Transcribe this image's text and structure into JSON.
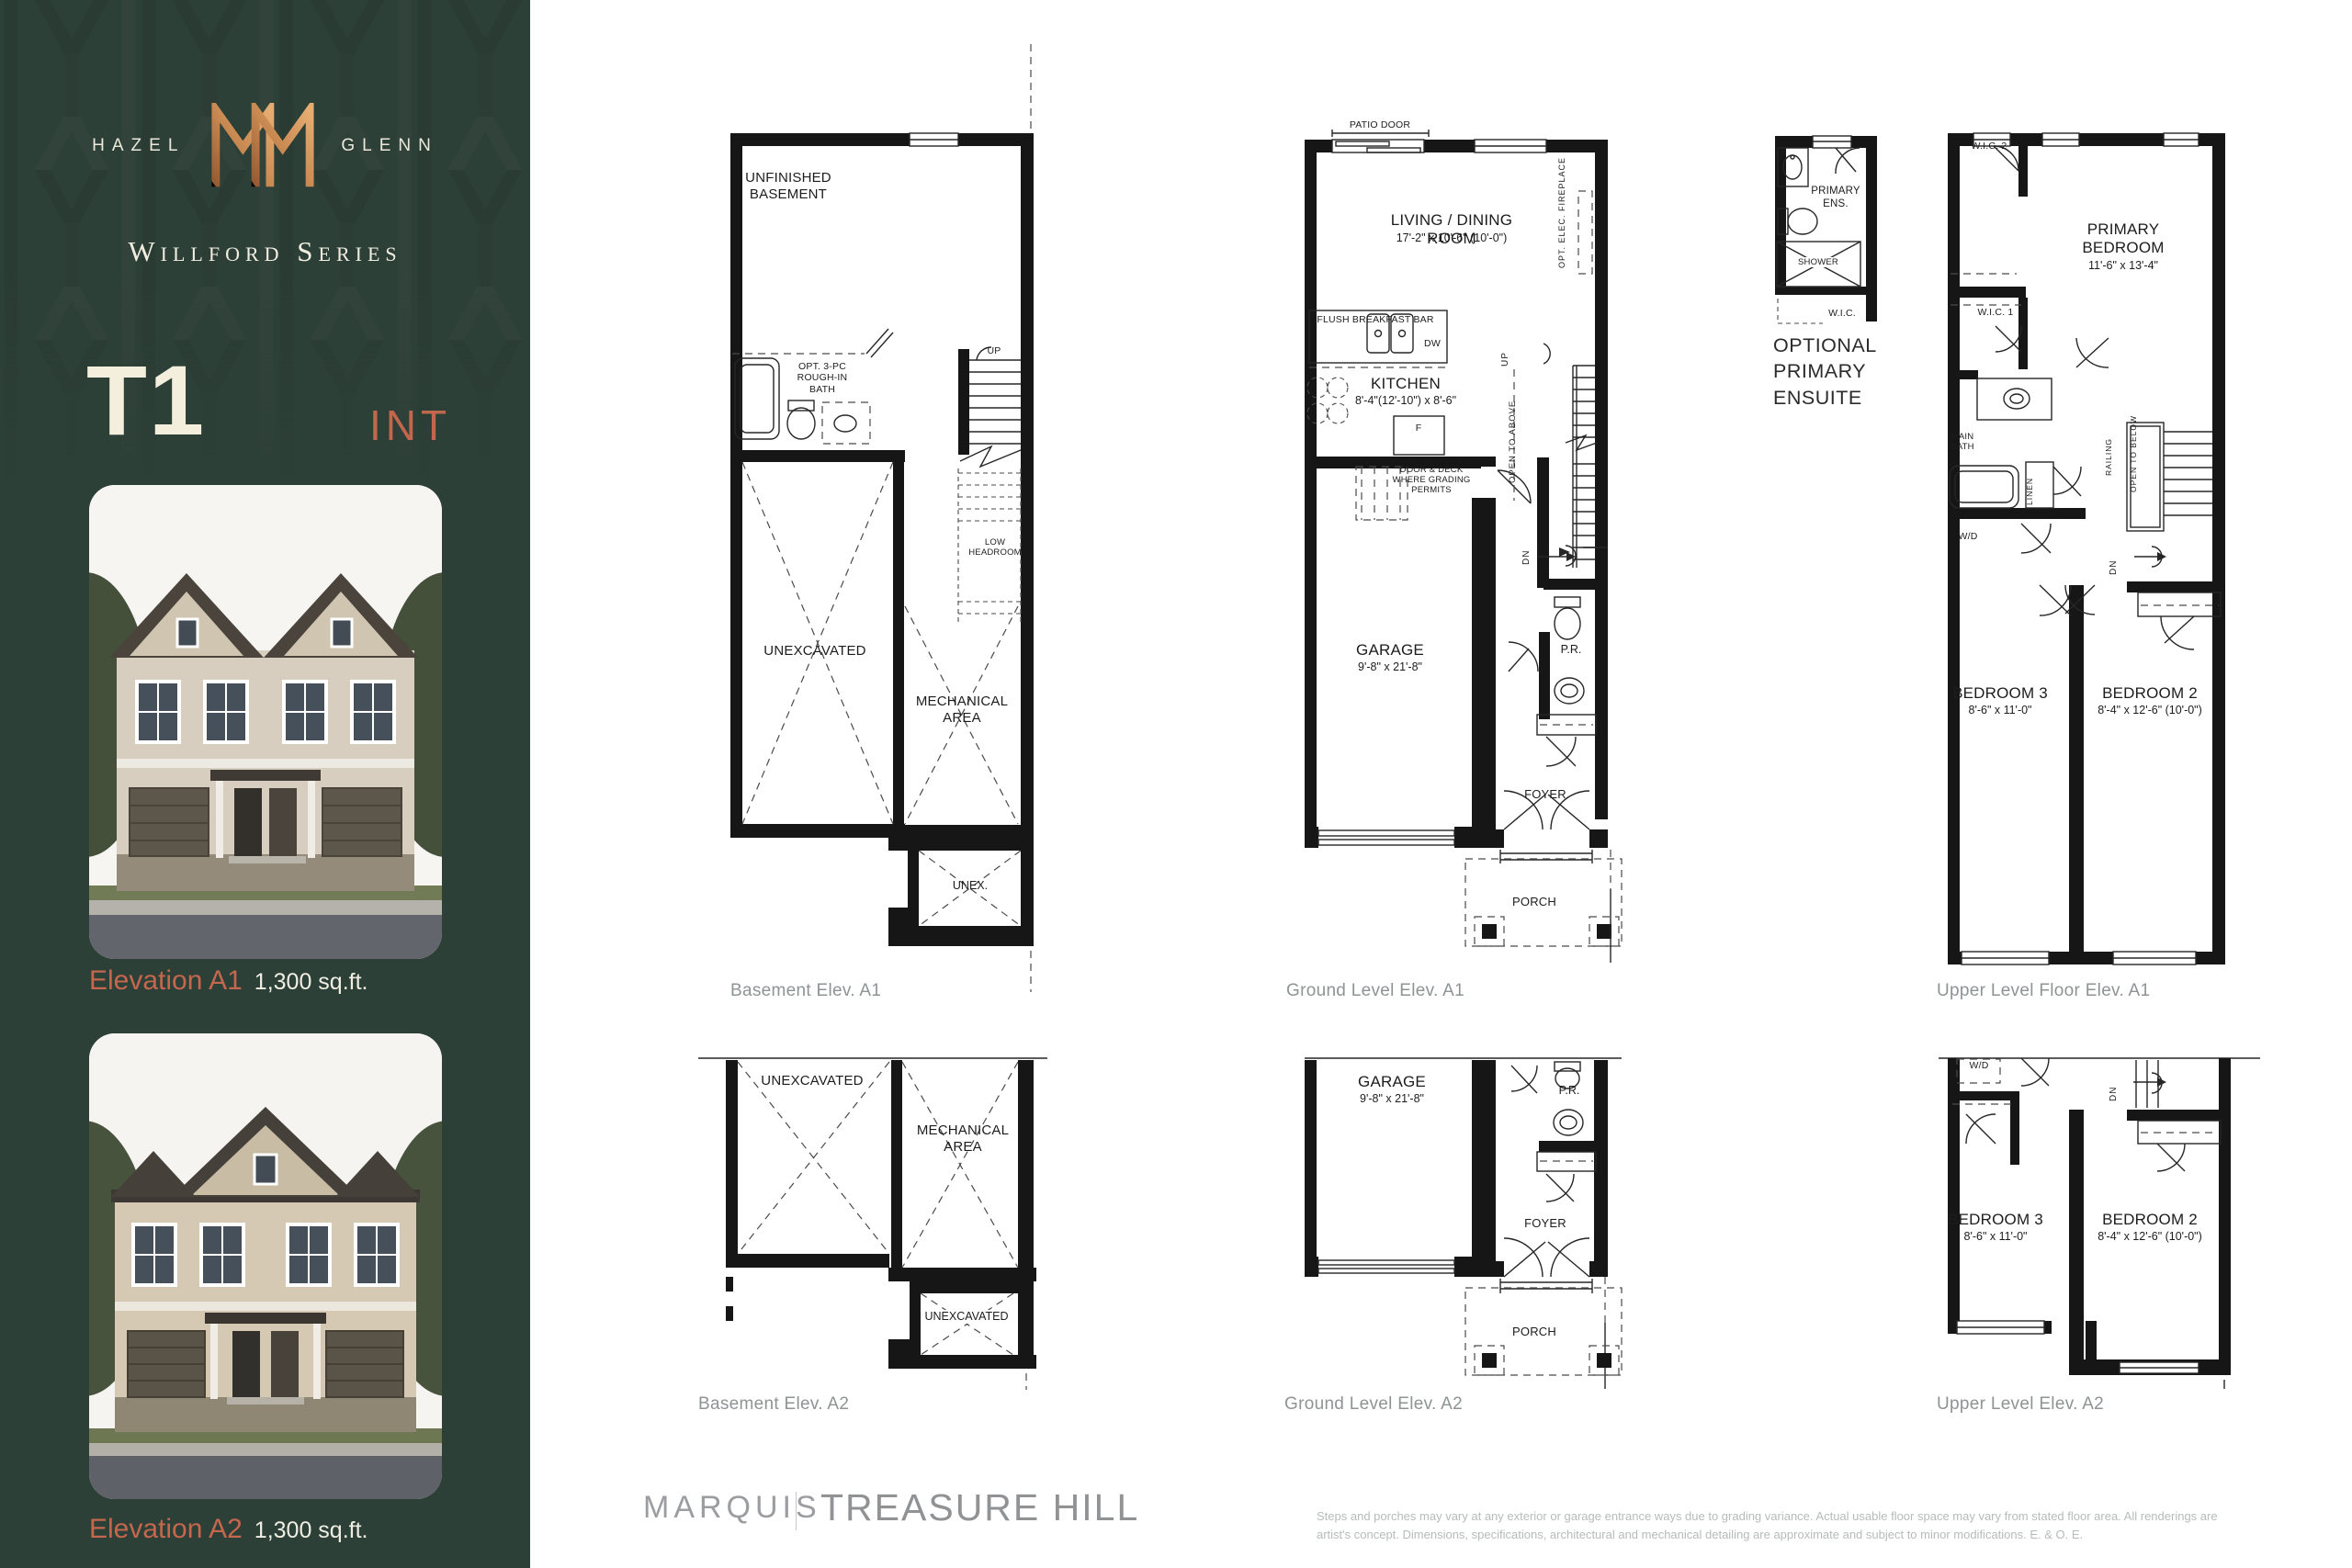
{
  "sidebar": {
    "brand_left": "HAZEL",
    "brand_right": "GLENN",
    "series": "Willford Series",
    "model": "T1",
    "model_tag": "INT",
    "elevations": [
      {
        "label": "Elevation A1",
        "area": "1,300 sq.ft."
      },
      {
        "label": "Elevation A2",
        "area": "1,300 sq.ft."
      }
    ]
  },
  "plans": {
    "basement_a1": {
      "caption": "Basement Elev. A1",
      "unfinished": "UNFINISHED\nBASEMENT",
      "opt_bath": "OPT. 3-PC\nROUGH-IN\nBATH",
      "up": "UP",
      "low_headroom": "LOW\nHEADROOM",
      "unexcavated": "UNEXCAVATED",
      "mechanical": "MECHANICAL\nAREA",
      "unex": "UNEX."
    },
    "ground_a1": {
      "caption": "Ground Level Elev. A1",
      "patio_door": "PATIO DOOR",
      "living": "LIVING / DINING ROOM",
      "living_dims": "17'-2\" x 10'-6\" (10'-0\")",
      "fireplace": "OPT. ELEC. FIREPLACE",
      "breakfast_bar": "FLUSH BREAKFAST BAR",
      "dw": "DW",
      "kitchen": "KITCHEN",
      "kitchen_dims": "8'-4\"(12'-10\") x 8'-6\"",
      "fridge": "F",
      "up": "UP",
      "door_deck": "DOOR & DECK\nWHERE GRADING\nPERMITS",
      "open_above": "OPEN TO ABOVE",
      "dn": "DN",
      "garage": "GARAGE",
      "garage_dims": "9'-8\" x 21'-8\"",
      "pr": "P.R.",
      "foyer": "FOYER",
      "porch": "PORCH"
    },
    "upper_a1": {
      "caption": "Upper Level Floor Elev. A1",
      "wic2": "W.I.C. 2",
      "primary": "PRIMARY\nBEDROOM",
      "primary_dims": "11'-6\" x 13'-4\"",
      "wic1": "W.I.C. 1",
      "main_bath": "MAIN\nBATH",
      "linen": "LINEN",
      "wd": "W/D",
      "railing": "RAILING",
      "open_below": "OPEN TO BELOW",
      "dn": "DN",
      "bedroom3": "BEDROOM 3",
      "bedroom3_dims": "8'-6\" x 11'-0\"",
      "bedroom2": "BEDROOM 2",
      "bedroom2_dims": "8'-4\" x 12'-6\" (10'-0\")"
    },
    "ensuite": {
      "caption": "OPTIONAL\nPRIMARY\nENSUITE",
      "primary_ens": "PRIMARY\nENS.",
      "shower": "SHOWER",
      "wic": "W.I.C."
    },
    "basement_a2": {
      "caption": "Basement Elev. A2",
      "unexcavated": "UNEXCAVATED",
      "mechanical": "MECHANICAL\nAREA",
      "unexcavated2": "UNEXCAVATED"
    },
    "ground_a2": {
      "caption": "Ground Level Elev. A2",
      "garage": "GARAGE",
      "garage_dims": "9'-8\" x 21'-8\"",
      "pr": "P.R.",
      "foyer": "FOYER",
      "porch": "PORCH"
    },
    "upper_a2": {
      "caption": "Upper Level Elev. A2",
      "wd": "W/D",
      "dn": "DN",
      "bedroom3": "BEDROOM 3",
      "bedroom3_dims": "8'-6\" x 11'-0\"",
      "bedroom2": "BEDROOM 2",
      "bedroom2_dims": "8'-4\" x 12'-6\" (10'-0\")"
    }
  },
  "footer": {
    "builder": "MARQUIS",
    "developer": "TREASURE HILL",
    "disclaimer": "Steps and porches may vary at any exterior or garage entrance ways due to grading variance. Actual usable floor space may vary from stated floor area. All renderings are\nartist's concept. Dimensions, specifications, architectural and mechanical detailing are approximate and subject to minor modifications. E. & O. E."
  },
  "colors": {
    "sidebar_green": "#2d4038",
    "copper": "#c98a52",
    "terracotta": "#c2664c",
    "cream": "#f4efdc",
    "caption_gray": "#8e9394"
  }
}
